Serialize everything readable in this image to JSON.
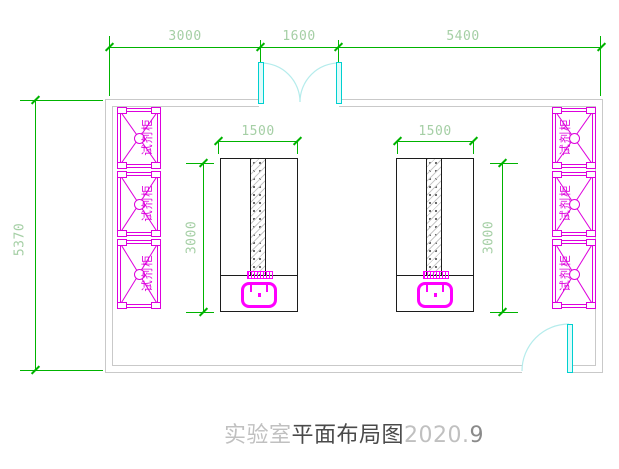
{
  "title": {
    "head": "实验室",
    "middle": "平面布局图",
    "year": "2020.",
    "tail": "9"
  },
  "dimensions": {
    "top": [
      "3000",
      "1600",
      "5400"
    ],
    "room_height": "5370",
    "bench_width_left": "1500",
    "bench_width_right": "1500",
    "bench_depth_left": "3000",
    "bench_depth_right": "3000"
  },
  "cabinets": {
    "left": [
      {
        "label": "试剂柜"
      },
      {
        "label": "试剂柜"
      },
      {
        "label": "试剂柜"
      }
    ],
    "right": [
      {
        "label": "试剂柜"
      },
      {
        "label": "试剂柜"
      },
      {
        "label": "试剂柜"
      }
    ]
  },
  "colors": {
    "dimension_line": "#00b300",
    "dimension_text": "#a5cfa5",
    "cabinet_magenta": "#dd00dd",
    "fixture_magenta": "#ff00ff",
    "door_cyan": "#00d0d0",
    "door_fill": "#dffbfb",
    "arc_cyan": "#b5ecec",
    "wall_gray": "#c9c9c9",
    "bench_line": "#1c1c1c",
    "title_gray": "#c0c0c0",
    "title_dark": "#4a4a4a",
    "title_mid": "#8a8a8a"
  }
}
